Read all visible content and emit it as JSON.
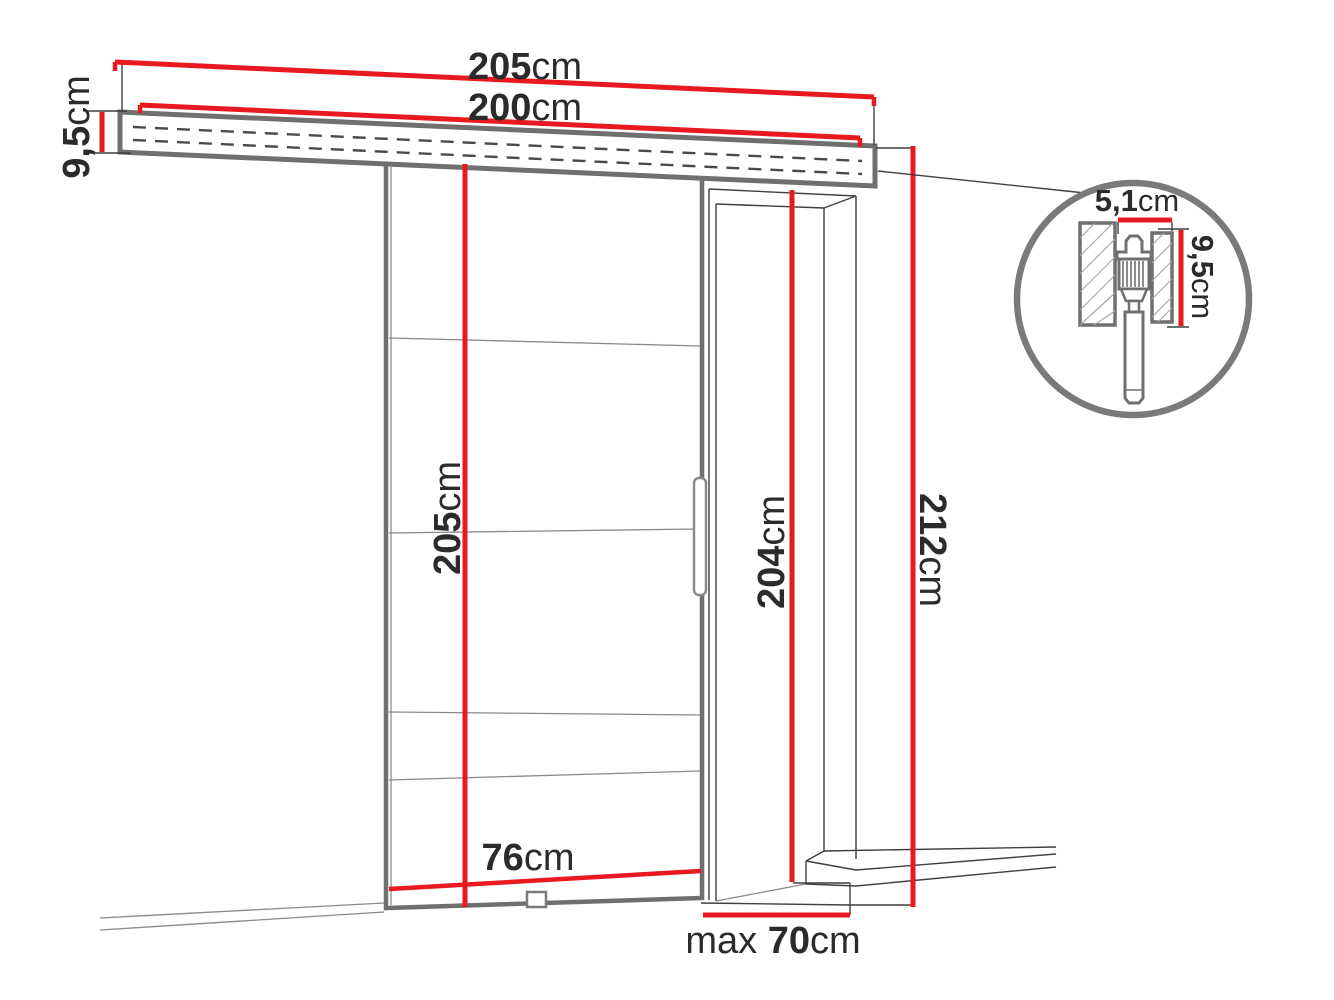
{
  "colors": {
    "dimension_red": "#e8191f",
    "outline_gray": "#6f6f6f",
    "thin_line": "#3f3f3f",
    "text_dark": "#2b2b2b"
  },
  "diagram": {
    "subject": "sliding-door-system-dimension-drawing",
    "dimensions": {
      "track_length": {
        "value": "205",
        "unit": "cm"
      },
      "mount_length": {
        "value": "200",
        "unit": "cm"
      },
      "rail_height": {
        "value": "9,5",
        "unit": "cm"
      },
      "door_height": {
        "value": "205",
        "unit": "cm"
      },
      "door_width": {
        "value": "76",
        "unit": "cm"
      },
      "opening_height": {
        "value": "204",
        "unit": "cm"
      },
      "total_height": {
        "value": "212",
        "unit": "cm"
      },
      "max_width": {
        "prefix": "max ",
        "value": "70",
        "unit": "cm"
      },
      "detail_width": {
        "value": "5,1",
        "unit": "cm"
      },
      "detail_height": {
        "value": "9,5",
        "unit": "cm"
      }
    }
  }
}
